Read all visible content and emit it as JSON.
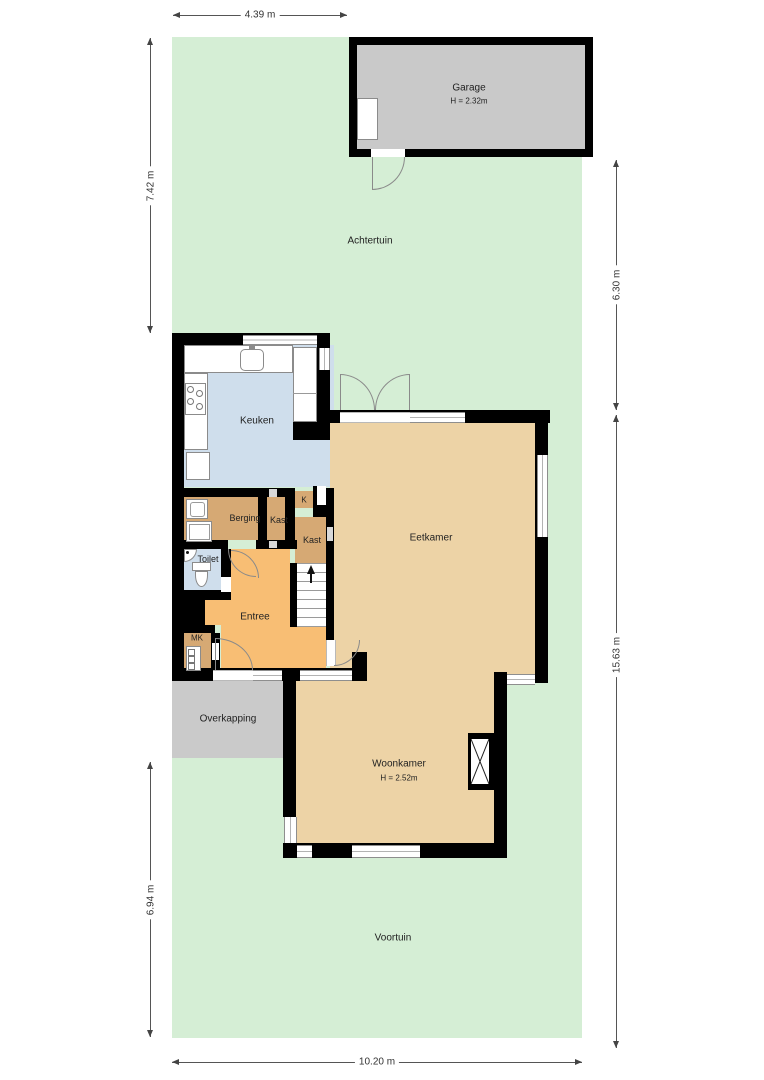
{
  "colors": {
    "wall": "#000000",
    "garden": "#d5eed5",
    "garage": "#c9c9c9",
    "overkapping": "#cacaca",
    "kitchen": "#cfdeec",
    "storage": "#d6a974",
    "entrance": "#f8be74",
    "living": "#edd3a6"
  },
  "gardens": {
    "achtertuin": "Achtertuin",
    "voortuin": "Voortuin"
  },
  "rooms": {
    "garage": {
      "name": "Garage",
      "height": "H = 2.32m"
    },
    "keuken": {
      "name": "Keuken"
    },
    "berging": {
      "name": "Berging"
    },
    "kast_hal": {
      "name": "Kast"
    },
    "kast_klein": {
      "name": "K"
    },
    "kast_trap": {
      "name": "Kast"
    },
    "toilet": {
      "name": "Toilet"
    },
    "entree": {
      "name": "Entree"
    },
    "mk": {
      "name": "MK"
    },
    "eetkamer": {
      "name": "Eetkamer"
    },
    "woonkamer": {
      "name": "Woonkamer",
      "height": "H = 2.52m"
    },
    "overkapping": {
      "name": "Overkapping"
    }
  },
  "dimensions": {
    "top": "4.39 m",
    "left_upper": "7.42 m",
    "left_lower": "6.94 m",
    "right_upper": "6.30 m",
    "right_lower": "15.63 m",
    "bottom": "10.20 m"
  }
}
